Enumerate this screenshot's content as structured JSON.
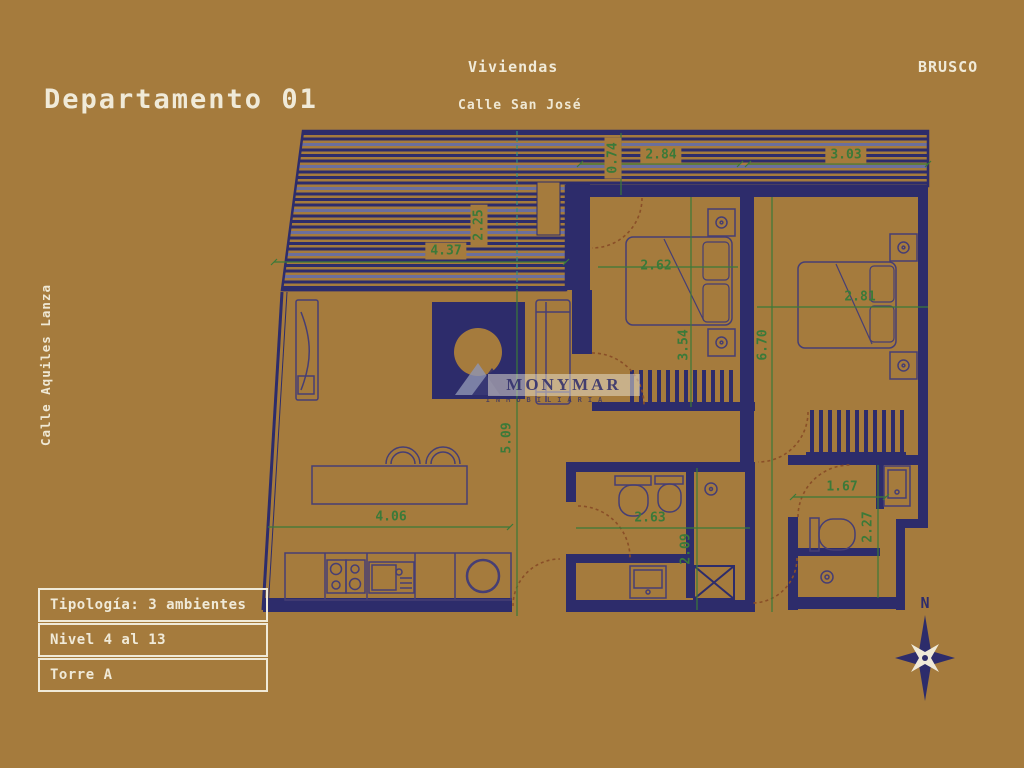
{
  "header": {
    "title": "Departamento 01",
    "center_label": "Viviendas",
    "brand": "BRUSCO"
  },
  "streets": {
    "top": "Calle San José",
    "left": "Calle Aquiles Lanza"
  },
  "info_panel": {
    "rows": [
      {
        "label": "Tipología: 3 ambientes"
      },
      {
        "label": "Nivel 4 al 13"
      },
      {
        "label": "Torre A"
      }
    ]
  },
  "dimensions": {
    "terrace_depth": "2.25",
    "terrace_width": "4.37",
    "balcony_depth": "0.74",
    "bedroom1_width_top": "2.84",
    "bedroom2_width_top": "3.03",
    "bedroom1_width": "2.62",
    "bedroom1_depth": "3.54",
    "apartment_depth": "6.70",
    "bedroom2_width": "2.81",
    "living_depth": "5.09",
    "living_width": "4.06",
    "bathroom1_width": "2.63",
    "bathroom1_depth": "2.09",
    "bathroom2_width": "1.67",
    "bathroom2_depth": "2.27"
  },
  "watermark": {
    "name": "MONYMAR",
    "subtitle": "INMOBILIARIA"
  },
  "compass": {
    "label": "N"
  },
  "colors": {
    "background": "#a57b3d",
    "plan_line": "#2d2c6b",
    "dimension_green": "#3b7a39",
    "text_cream": "#f0ead8"
  }
}
